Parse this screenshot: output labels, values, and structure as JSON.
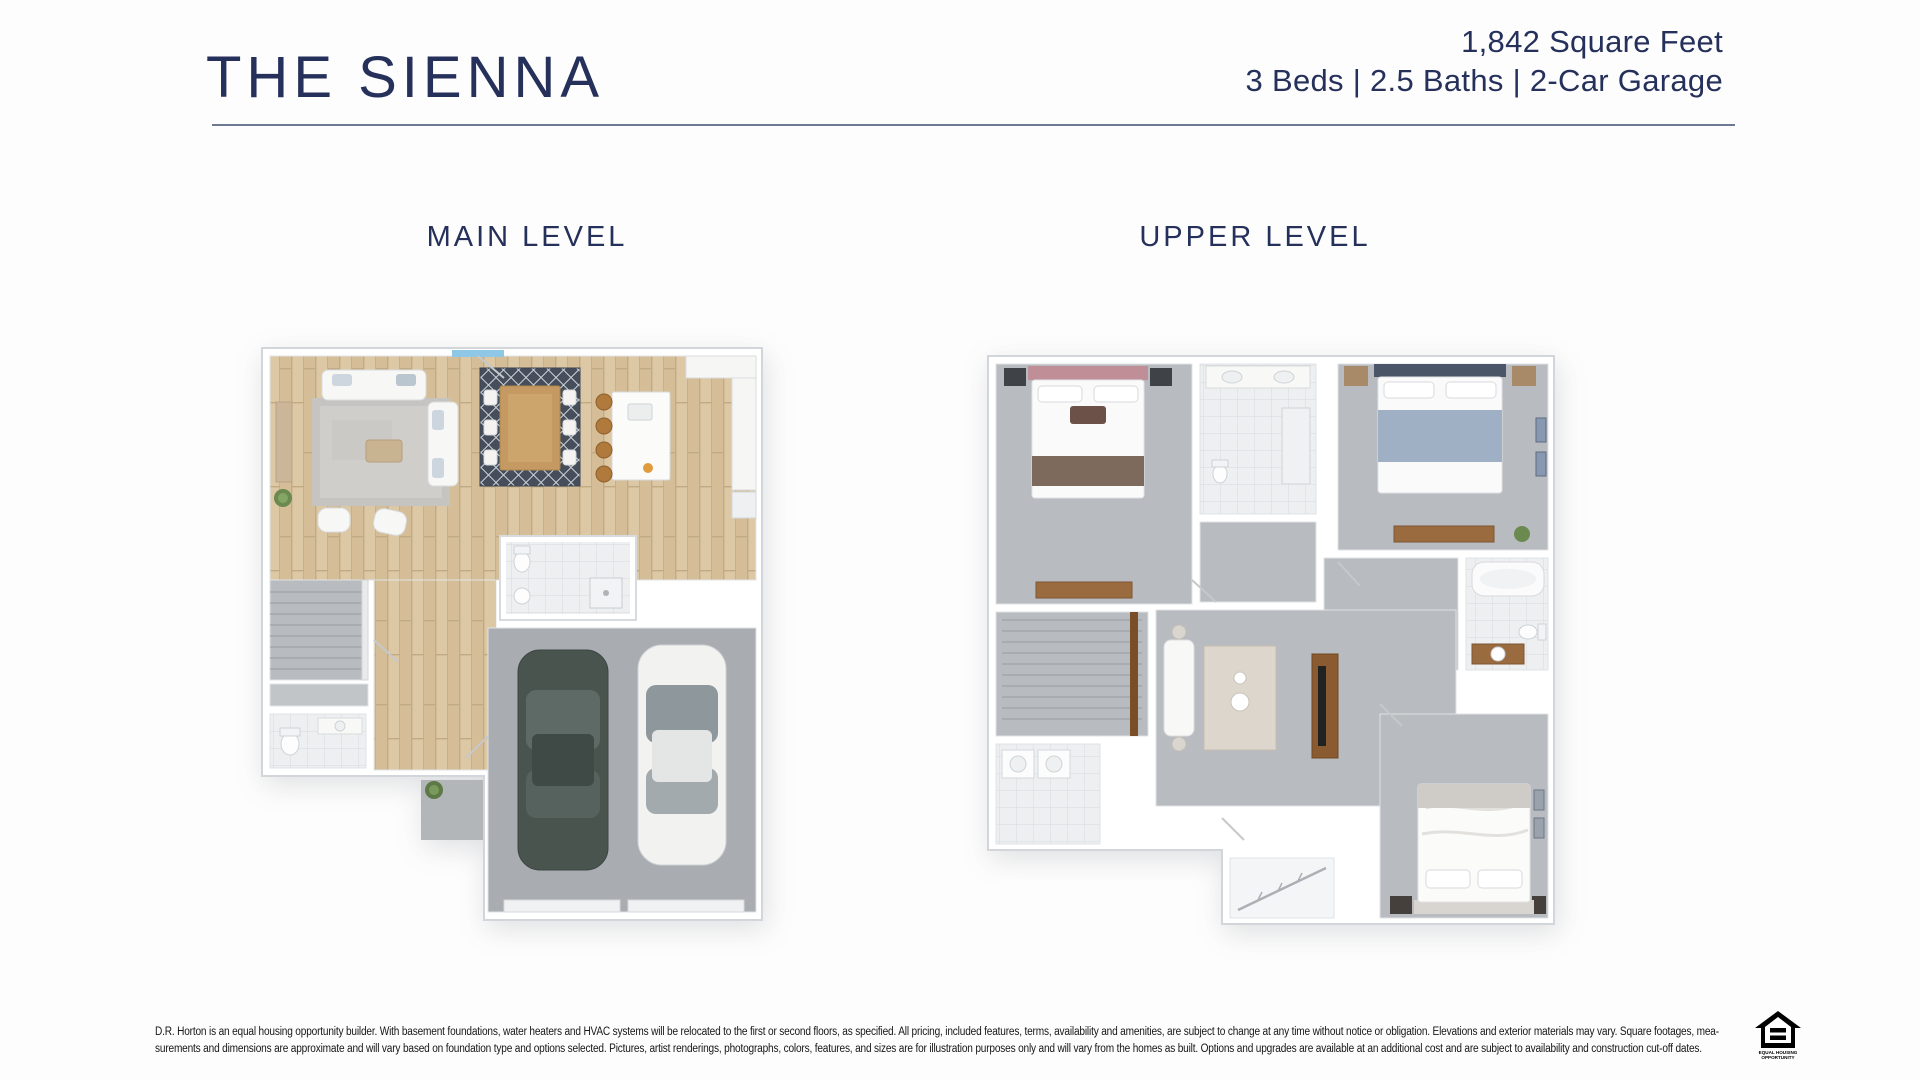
{
  "header": {
    "title": "THE SIENNA",
    "stats_line1": "1,842 Square Feet",
    "stats_line2": "3 Beds | 2.5 Baths | 2-Car Garage"
  },
  "plans": {
    "main": {
      "label": "MAIN LEVEL"
    },
    "upper": {
      "label": "UPPER LEVEL"
    }
  },
  "disclaimer": {
    "line1": "D.R. Horton is an equal housing opportunity builder. With basement foundations, water heaters and HVAC systems will be relocated to the first or second floors, as specified. All pricing, included features, terms, availability and amenities, are subject to change at any time without notice or obligation. Elevations and exterior materials may vary. Square footages, mea-",
    "line2": "surements and dimensions are approximate and will vary based on foundation type and options selected. Pictures, artist renderings, photographs, colors, features, and sizes are for illustration purposes only and will vary from the homes as built. Options and upgrades are available at an additional cost and are subject to availability and construction cut-off dates."
  },
  "logo": {
    "line1": "EQUAL HOUSING",
    "line2": "OPPORTUNITY"
  },
  "colors": {
    "navy": "#25305b",
    "rule_gray_blue": "#6e7a93",
    "wood_floor": "#dcc8a5",
    "carpet_gray": "#b8bbbf",
    "garage_concrete": "#a9adb1",
    "tile": "#edeff1",
    "disclaimer_text": "#161616"
  }
}
